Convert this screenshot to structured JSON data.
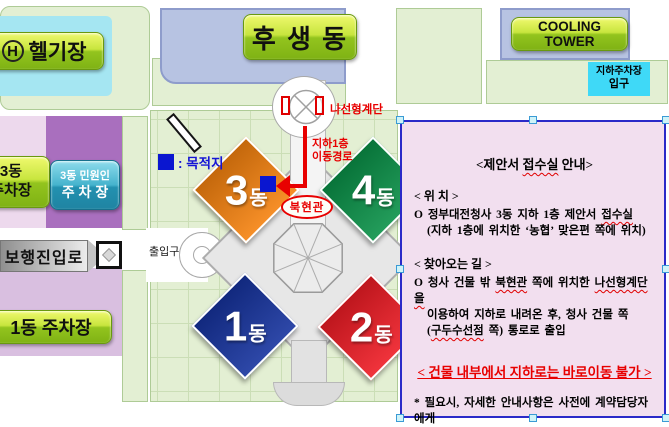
{
  "map": {
    "heliport": {
      "icon": "H",
      "label": "헬기장"
    },
    "husaeng": "후 생 동",
    "cooling_tower": "COOLING TOWER",
    "underground_parking": {
      "line1": "지하주차장",
      "line2": "입구"
    },
    "parking_3dong": {
      "line1": "3동",
      "line2": "주차장"
    },
    "civil_parking": {
      "line1": "3동 민원인",
      "line2": "주 차 장"
    },
    "parking_1dong": "1동 주차장",
    "pedestrian_entry": "보행진입로",
    "gate": "출입구",
    "spiral_staircase": "나선형계단",
    "route": {
      "line1": "지하1층",
      "line2": "이동경로"
    },
    "destination_legend": ": 목적지",
    "north_hall": "북현관",
    "buildings": [
      {
        "id": "dong-3",
        "num": "3",
        "suffix": "동",
        "color": "#F5820F"
      },
      {
        "id": "dong-4",
        "num": "4",
        "suffix": "동",
        "color": "#0A9148"
      },
      {
        "id": "dong-1",
        "num": "1",
        "suffix": "동",
        "color": "#16339E"
      },
      {
        "id": "dong-2",
        "num": "2",
        "suffix": "동",
        "color": "#EE1C25"
      }
    ]
  },
  "infobox": {
    "lines": [
      {
        "type": "title",
        "segments": [
          {
            "t": "<제안서 "
          },
          {
            "t": "접수실",
            "sp": true
          },
          {
            "t": " 안내>"
          }
        ]
      },
      {
        "type": "h",
        "text": "< 위 치 >"
      },
      {
        "type": "b",
        "segments": [
          {
            "t": "O 정부대전청사 3동 지하 1층 제안서 "
          },
          {
            "t": "접수실",
            "sp": true
          }
        ]
      },
      {
        "type": "i",
        "segments": [
          {
            "t": "(지하 1층에 위치한 ‘농협’ 맞은편 쪽에 위치)"
          }
        ]
      },
      {
        "type": "gap"
      },
      {
        "type": "h",
        "text": "< 찾아오는 길 >"
      },
      {
        "type": "b",
        "segments": [
          {
            "t": "O 청사 건물 밖 "
          },
          {
            "t": "북현관",
            "sp": true
          },
          {
            "t": " 쪽에 위치한 "
          },
          {
            "t": "나선형계단을",
            "sp": true
          }
        ]
      },
      {
        "type": "i",
        "segments": [
          {
            "t": "이용하여 지하로 내려온 후, 청사 건물 쪽"
          }
        ]
      },
      {
        "type": "i",
        "segments": [
          {
            "t": "("
          },
          {
            "t": "구두수선점",
            "sp": true
          },
          {
            "t": " 쪽) 통로로 출입"
          }
        ]
      },
      {
        "type": "gap"
      },
      {
        "type": "warn",
        "text": "< 건물 내부에서 지하로는 바로이동 불가 >"
      },
      {
        "type": "gap"
      },
      {
        "type": "b",
        "segments": [
          {
            "t": "* 필요시, 자세한 안내사항은 사전에 계약담당자에게"
          }
        ]
      },
      {
        "type": "i",
        "segments": [
          {
            "t": "문의하시기 바랍니다."
          }
        ]
      }
    ]
  },
  "colors": {
    "building_3": "#F5820F",
    "building_4": "#0A9148",
    "building_1": "#16339E",
    "building_2": "#EE1C25",
    "route_red": "#E80000",
    "destination_blue": "#0A16D0",
    "infobox_bg": "#F2DFEF",
    "infobox_border": "#2A2AC8",
    "map_green": "#E3EFD3",
    "heliport_cyan": "#A5E6F2"
  }
}
